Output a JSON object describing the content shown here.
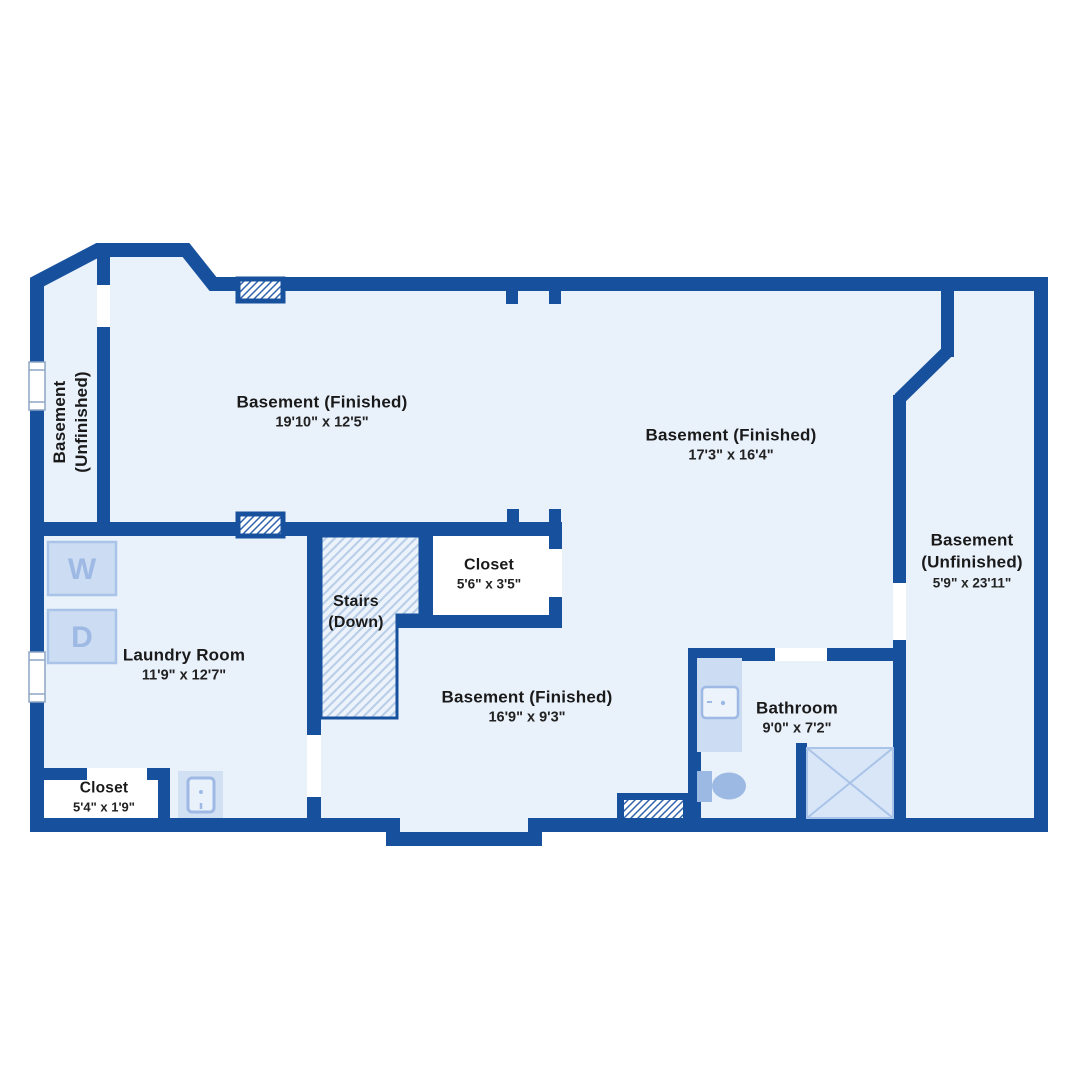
{
  "title": "Basement floor plan",
  "colors": {
    "wall": "#17519e",
    "floor": "#e9f1fb",
    "closet_floor": "#ffffff",
    "fixture_fill": "#ccdcf3",
    "fixture_border": "#a9c4e8",
    "fixture_letter": "#9db9e4",
    "stairs_hatch_line": "#b9cfe9",
    "vent_hatch_line": "#2f62ac",
    "shower_fill": "#d9e6f7",
    "toilet_fill": "#9cb9e3",
    "text": "#1a1a1a"
  },
  "rooms": {
    "left_unfinished": {
      "name_line1": "Basement",
      "name_line2": "(Unfinished)"
    },
    "top_left_finished": {
      "name": "Basement (Finished)",
      "dims": "19'10\" x 12'5\""
    },
    "top_right_finished": {
      "name": "Basement (Finished)",
      "dims": "17'3\" x 16'4\""
    },
    "right_unfinished": {
      "name_line1": "Basement",
      "name_line2": "(Unfinished)",
      "dims": "5'9\" x 23'11\""
    },
    "closet_top": {
      "name": "Closet",
      "dims": "5'6\" x 3'5\""
    },
    "stairs": {
      "name_line1": "Stairs",
      "name_line2": "(Down)"
    },
    "laundry": {
      "name": "Laundry Room",
      "dims": "11'9\" x 12'7\""
    },
    "middle_finished": {
      "name": "Basement (Finished)",
      "dims": "16'9\" x 9'3\""
    },
    "bathroom": {
      "name": "Bathroom",
      "dims": "9'0\" x 7'2\""
    },
    "closet_bottom": {
      "name": "Closet",
      "dims": "5'4\" x 1'9\""
    }
  },
  "fixtures": {
    "washer_label": "W",
    "dryer_label": "D"
  }
}
